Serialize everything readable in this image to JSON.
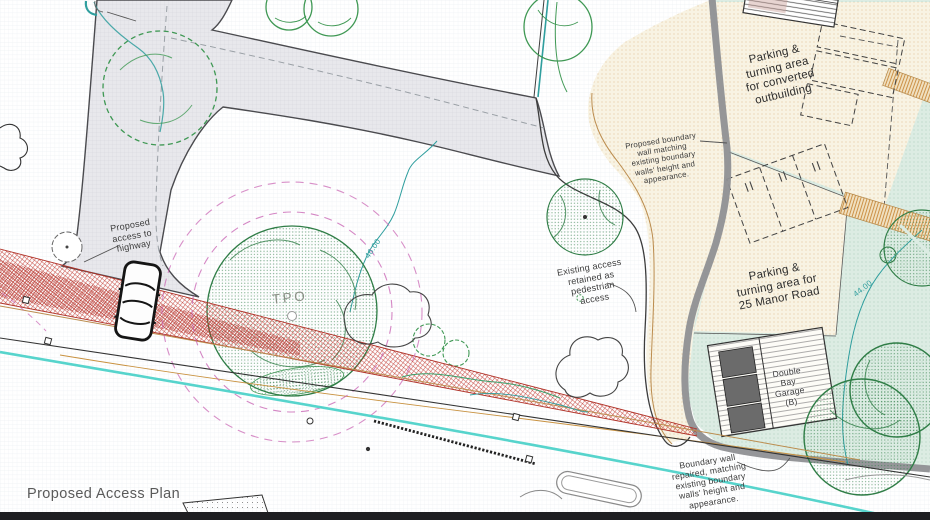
{
  "plan": {
    "title": "Proposed Access Plan",
    "labels": {
      "tpo": "TPO",
      "proposed_access": [
        "Proposed",
        "access to",
        "highway"
      ],
      "existing_access": [
        "Existing access",
        "retained as",
        "pedestrian",
        "access"
      ],
      "proposed_wall": [
        "Proposed boundary",
        "wall matching",
        "existing boundary",
        "walls' height and",
        "appearance."
      ],
      "parking_outbuilding": [
        "Parking &",
        "turning area",
        "for converted",
        "outbuilding"
      ],
      "parking_manor": [
        "Parking &",
        "turning area for",
        "25 Manor Road"
      ],
      "garage": [
        "Double",
        "Bay",
        "Garage",
        "(B)"
      ],
      "repaired_wall": [
        "Boundary wall",
        "repaired, matching",
        "existing boundary",
        "walls' height and",
        "appearance."
      ],
      "contour_46": "46.00",
      "contour_44": "44.00"
    },
    "colors": {
      "splay_red": "#c03228",
      "contour_teal": "#2f9e9e",
      "tree_green": "#2f7d46",
      "tree_light": "#3f9854",
      "cream_fill": "#f8f3e3",
      "mint_fill": "#dcece3",
      "wall_grey": "#8f9093",
      "road_cyan": "#45cfc7",
      "tpo_magenta": "#c75fb1",
      "tan_brown": "#bb8c4e",
      "drive_grey": "#e8e8ec"
    }
  }
}
